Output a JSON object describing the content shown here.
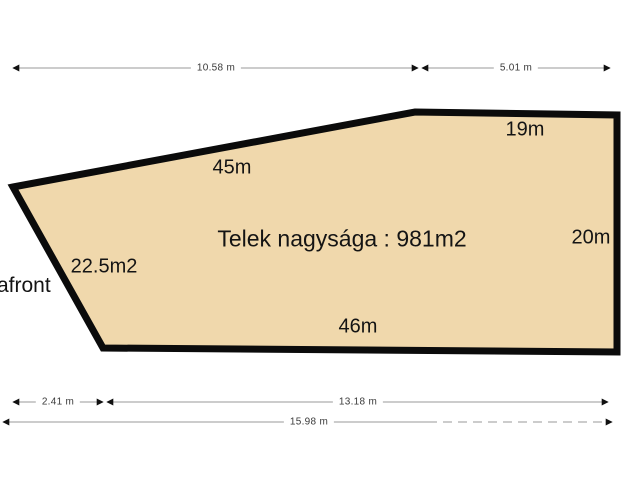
{
  "diagram": {
    "title": "Telek nagysága : 981m2",
    "street_label": "afront",
    "colors": {
      "plot_fill": "#f0d8ac",
      "plot_border": "#0b0b0b",
      "dimension_line": "#9a9a9a",
      "arrowhead": "#111111"
    },
    "side_labels": {
      "top_sloped_edge": "45m",
      "top_edge": "19m",
      "right_edge": "20m",
      "bottom_edge": "46m",
      "left_area": "22.5m2"
    },
    "dimensions": {
      "top_left_span": "10.58 m",
      "top_right_span": "5.01 m",
      "bottom_left_span": "2.41 m",
      "bottom_mid_span": "13.18 m",
      "bottom_total_span": "15.98 m"
    }
  }
}
